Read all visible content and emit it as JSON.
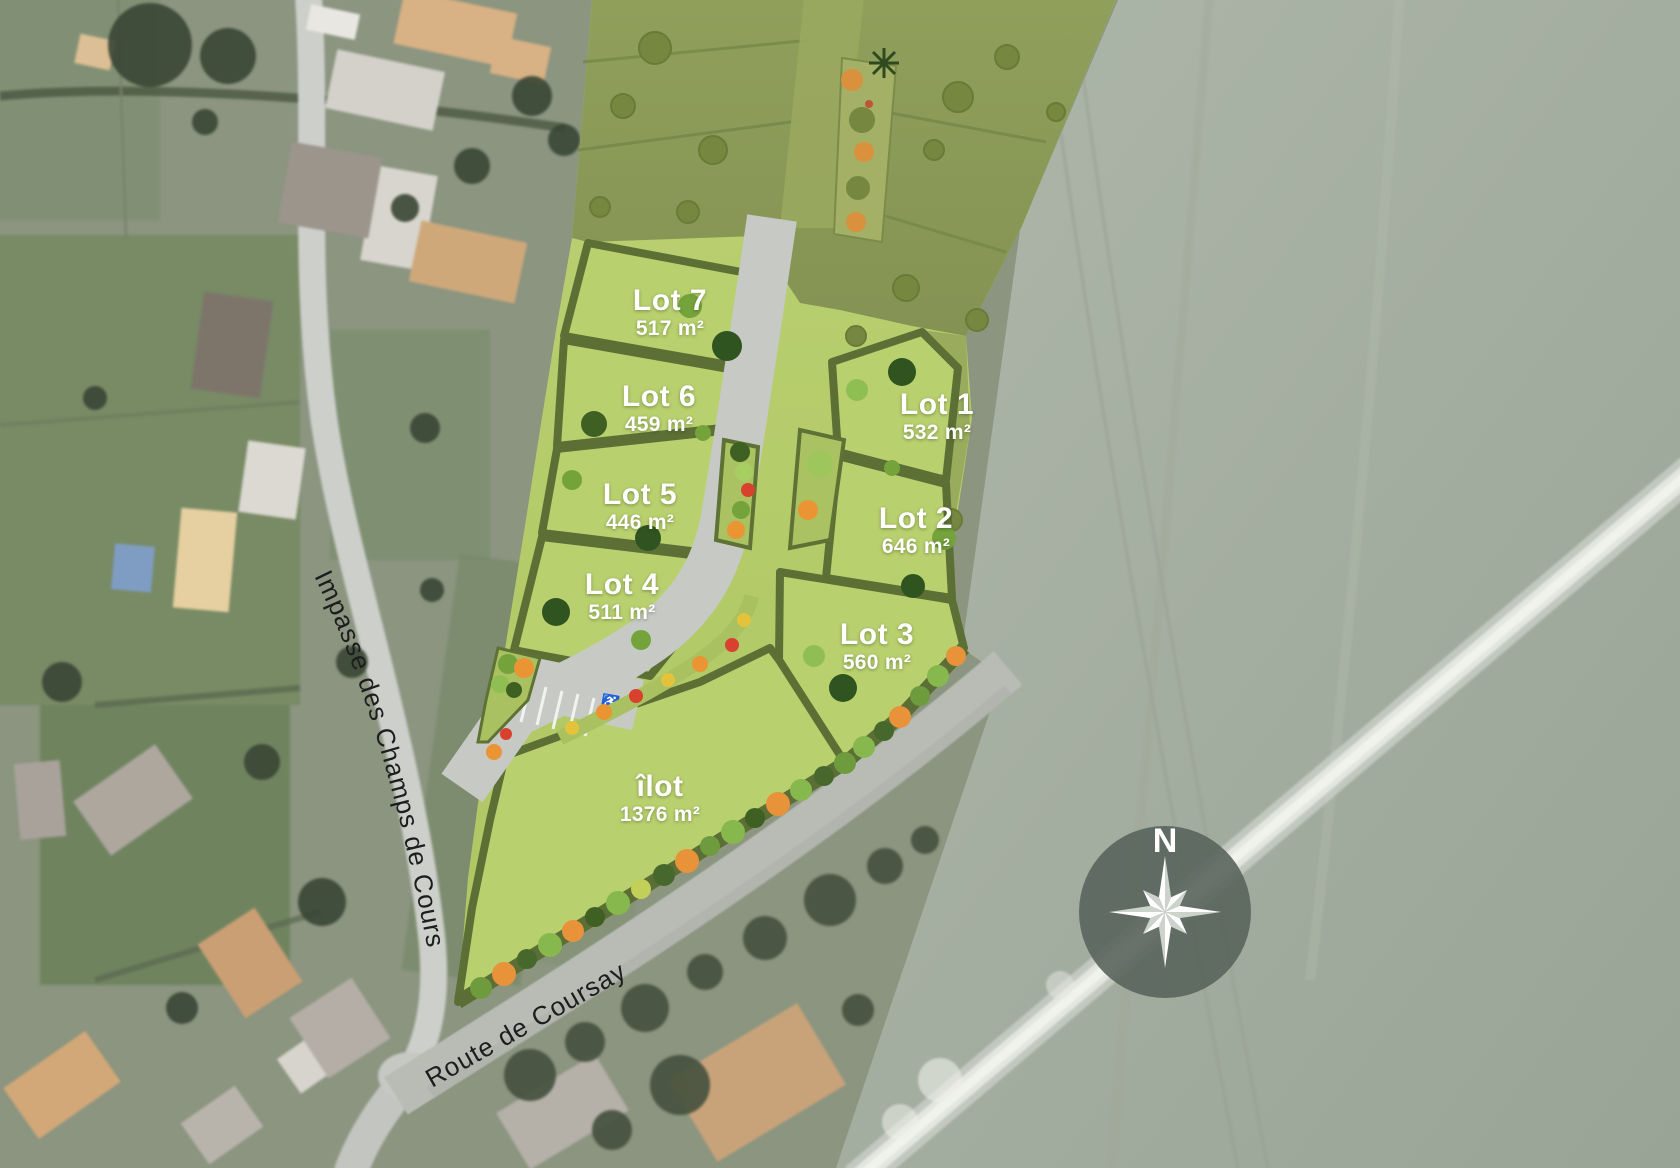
{
  "map": {
    "lots": [
      {
        "name": "Lot 1",
        "area": "532 m²"
      },
      {
        "name": "Lot 2",
        "area": "646 m²"
      },
      {
        "name": "Lot 3",
        "area": "560 m²"
      },
      {
        "name": "Lot 4",
        "area": "511 m²"
      },
      {
        "name": "Lot 5",
        "area": "446 m²"
      },
      {
        "name": "Lot 6",
        "area": "459 m²"
      },
      {
        "name": "Lot 7",
        "area": "517 m²"
      },
      {
        "name": "îlot",
        "area": "1376 m²"
      }
    ],
    "streets": {
      "impasse": "Impasse des Champs de Cours",
      "route": "Route de Coursay"
    },
    "compass": {
      "north_label": "N"
    },
    "parking": {
      "accessible_icon": "♿"
    },
    "colors": {
      "lot_green": "#b7ce6e",
      "hedge_green": "#5c6f35",
      "existing_phase_olive": "#8d9c57",
      "road_gray": "#c8cac6",
      "field_gray_green": "#a7b0a3",
      "shrub_orange": "#e8923a",
      "shrub_red": "#d8412e",
      "label_text": "#ffffff"
    }
  }
}
